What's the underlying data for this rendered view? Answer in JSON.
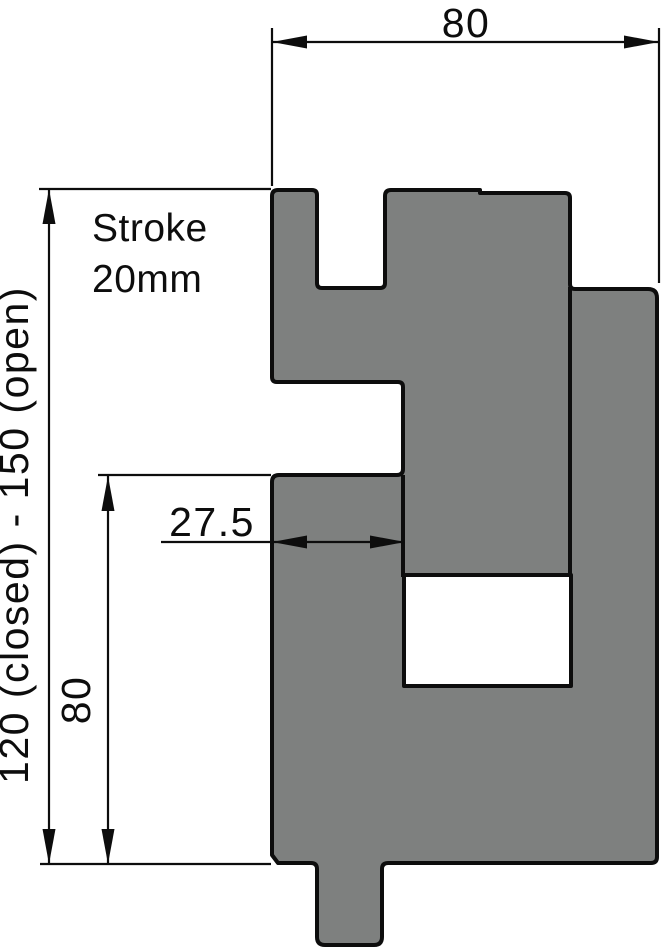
{
  "drawing": {
    "type": "technical-cross-section",
    "labels": {
      "top_width": "80",
      "overall_height": "120  (closed) - 150 (open)",
      "block_height": "80",
      "block_width": "27.5",
      "stroke_line1": "Stroke",
      "stroke_line2": "20mm"
    },
    "colors": {
      "part_fill": "#7E807F",
      "line": "#0D0D0D",
      "background": "#FFFFFF"
    }
  }
}
